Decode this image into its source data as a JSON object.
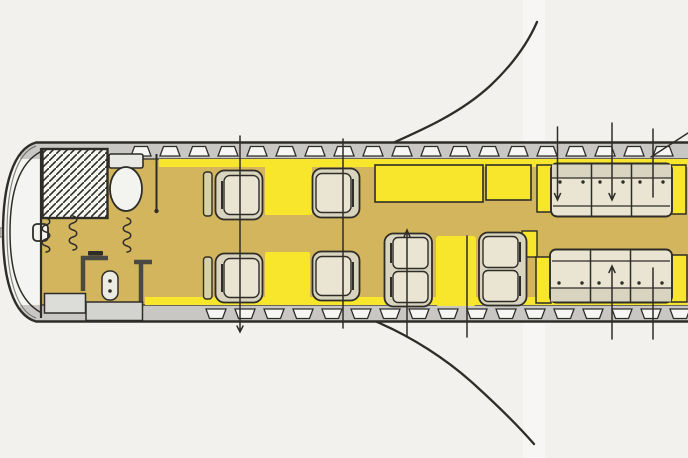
{
  "meta": {
    "title": "Business jet cabin floor plan sketch",
    "diagram_type": "aircraft-interior-plan-view"
  },
  "palette": {
    "background": "#f2f1ee",
    "outline": "#2e2d28",
    "fuselage_band": "#c8c7c3",
    "window": "#f6f6f4",
    "floor": "#d2b55c",
    "accent_yellow": "#f7e62b",
    "seat_fill": "#eae5d2",
    "seat_shell": "#d9d4bf",
    "cockpit": "#f4f4f2",
    "door_gray": "#dcdcd9",
    "wall_dark": "#4a4944"
  },
  "fuselage": {
    "windows": {
      "top": {
        "start": 131,
        "pitch": 29,
        "count": 19,
        "y": 145
      },
      "bottom": {
        "start": 206,
        "pitch": 29,
        "count": 17,
        "y": 308
      }
    }
  },
  "zones": [
    {
      "id": "cockpit",
      "label": "Cockpit"
    },
    {
      "id": "galley",
      "label": "Galley (hatched)"
    },
    {
      "id": "lavatory",
      "label": "Lavatory"
    },
    {
      "id": "entry-door",
      "label": "Entry door / airstair"
    },
    {
      "id": "forward-club-seating",
      "label": "Forward club-4 seating",
      "seats": 4,
      "tables": 2
    },
    {
      "id": "sideboard",
      "label": "Sideboard / credenza"
    },
    {
      "id": "conference-group",
      "label": "Conference group",
      "seats": 4,
      "tables": 1
    },
    {
      "id": "aft-divan-port",
      "label": "Aft divan, port side",
      "seats": 3
    },
    {
      "id": "aft-divan-starboard",
      "label": "Aft divan, starboard side",
      "seats": 3
    },
    {
      "id": "wing-roots",
      "label": "Wing leading-edge sketch lines"
    }
  ],
  "totals": {
    "passenger_seats": 14,
    "cabin_windows": 36,
    "curtains": 3,
    "dimension_marks": 9
  }
}
